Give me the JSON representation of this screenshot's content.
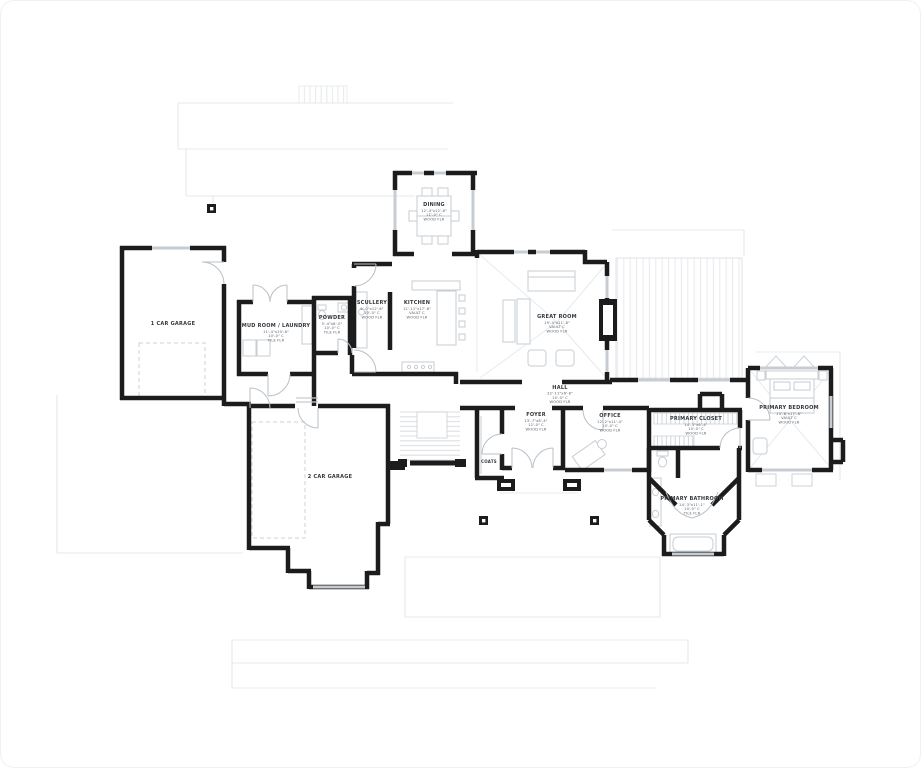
{
  "plan": {
    "type": "first-floor-plan",
    "colors": {
      "wall": "#1c1c1c",
      "window": "#c6ccd2",
      "furniture": "#c7cdd3",
      "roofline": "#e4e8ec",
      "deck_stripe": "#e7eaed",
      "label_text": "#33383d"
    },
    "rooms": [
      {
        "id": "one-car-garage",
        "name": "1 CAR GARAGE",
        "dims": "",
        "ceiling": "",
        "floor": ""
      },
      {
        "id": "two-car-garage",
        "name": "2 CAR GARAGE",
        "dims": "",
        "ceiling": "",
        "floor": ""
      },
      {
        "id": "mud-room-laundry",
        "name": "MUD ROOM / LAUNDRY",
        "dims": "11'-4\"x10'-8\"",
        "ceiling": "10'-0\" C",
        "floor": "TILE FLR"
      },
      {
        "id": "powder",
        "name": "POWDER",
        "dims": "5'-4\"x8'-0\"",
        "ceiling": "10'-0\" C",
        "floor": "TILE FLR"
      },
      {
        "id": "scullery",
        "name": "SCULLERY",
        "dims": "6'-0\"x12'-6\"",
        "ceiling": "10'-0\" C",
        "floor": "WOOD FLR"
      },
      {
        "id": "kitchen",
        "name": "KITCHEN",
        "dims": "12'-11\"x17'-8\"",
        "ceiling": "VAULT C",
        "floor": "WOOD FLR"
      },
      {
        "id": "dining",
        "name": "DINING",
        "dims": "12'-4\"x12'-6\"",
        "ceiling": "11'-0\" C",
        "floor": "WOOD FLR"
      },
      {
        "id": "great-room",
        "name": "GREAT ROOM",
        "dims": "19'-4\"x21'-8\"",
        "ceiling": "VAULT C",
        "floor": "WOOD FLR"
      },
      {
        "id": "hall",
        "name": "HALL",
        "dims": "32'-11\"x6'-8\"",
        "ceiling": "10'-0\" C",
        "floor": "WOOD FLR"
      },
      {
        "id": "foyer",
        "name": "FOYER",
        "dims": "13'-7\"x8'-4\"",
        "ceiling": "12'-0\" C",
        "floor": "WOOD FLR"
      },
      {
        "id": "coats",
        "name": "COATS",
        "dims": "",
        "ceiling": "",
        "floor": ""
      },
      {
        "id": "office",
        "name": "OFFICE",
        "dims": "12'-2\"x11'-4\"",
        "ceiling": "10'-0\" C",
        "floor": "WOOD FLR"
      },
      {
        "id": "primary-closet",
        "name": "PRIMARY CLOSET",
        "dims": "14'-3\"x6'-4\"",
        "ceiling": "10'-0\" C",
        "floor": "WOOD FLR"
      },
      {
        "id": "primary-bathroom",
        "name": "PRIMARY BATHROOM",
        "dims": "14'-3\"x11'-1\"",
        "ceiling": "10'-0\" C",
        "floor": "TILE FLR"
      },
      {
        "id": "primary-bedroom",
        "name": "PRIMARY BEDROOM",
        "dims": "13'-6\"x17'-8\"",
        "ceiling": "VAULT C",
        "floor": "WOOD FLR"
      }
    ]
  }
}
